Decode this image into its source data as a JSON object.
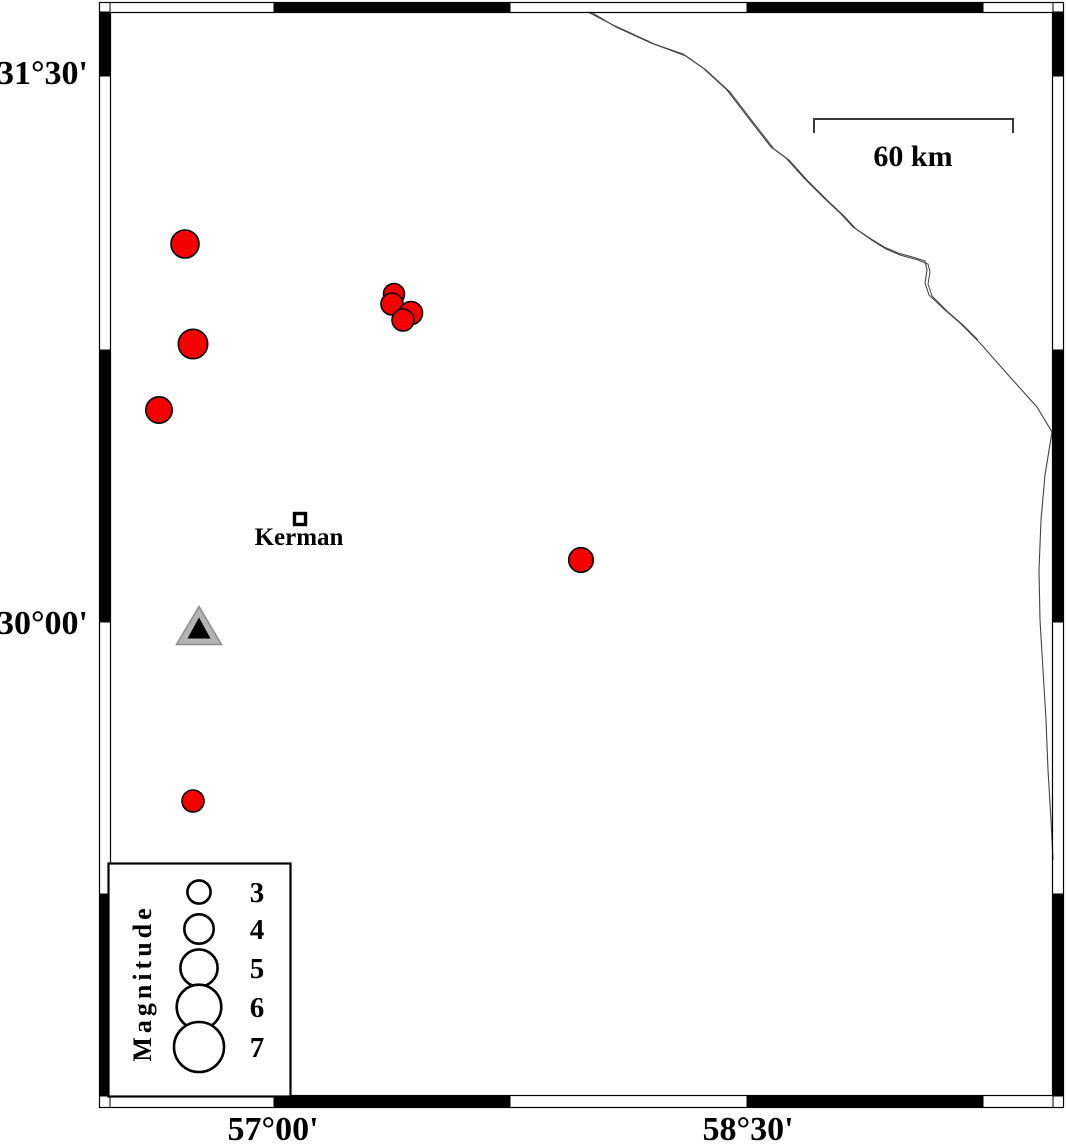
{
  "map": {
    "type": "seismicity-map",
    "background": "#ffffff"
  },
  "axis_labels": {
    "left": [
      {
        "text": "31°30'",
        "x": 88,
        "y": 84
      },
      {
        "text": "30°00'",
        "x": 88,
        "y": 634
      }
    ],
    "bottom": [
      {
        "text": "57°00'",
        "x": 273,
        "y": 1140
      },
      {
        "text": "58°30'",
        "x": 748,
        "y": 1140
      }
    ]
  },
  "frame": {
    "outer": {
      "x": 99,
      "y": 2,
      "w": 965,
      "h": 1106
    },
    "inner": {
      "x": 110,
      "y": 12,
      "w": 943,
      "h": 1084
    },
    "x_boundaries": [
      110,
      274,
      510,
      747,
      983,
      1053
    ],
    "x_black_segments": [
      [
        274,
        510
      ],
      [
        747,
        983
      ]
    ],
    "y_boundaries": [
      12,
      76,
      350,
      622,
      894,
      1096
    ],
    "y_black_segments": [
      [
        12,
        76
      ],
      [
        350,
        622
      ],
      [
        894,
        1096
      ]
    ],
    "band_color": "#000000"
  },
  "scale_bar": {
    "label": "60 km",
    "path": "M814,133 L814,119 L1013,119 L1013,133",
    "label_x": 913,
    "label_y": 166,
    "color": "#3a3a3a"
  },
  "coastline": {
    "color": "#444444",
    "main_d": "M588,12 L613,25 L648,41 L654,44 L683,54 L703,68 L727,90 L750,120 L771,147 L786,158 L804,178 L824,198 L841,214 L853,227 L871,239 L884,247 L898,253 L916,258 L925,261 L927,270 L925,283 L929,295 L945,310 L960,323 L980,343 L1010,377 L1037,407 L1052,432 L1045,475 L1041,520 L1039,570 L1040,620 L1043,670 L1046,720 L1048,770 L1051,820 L1053,860",
    "parallel_d": "M591,12 L616,27 L651,43 L686,56 L706,70 L730,92 L753,122 L774,149 L789,160 L807,180 L827,200 L844,216 L856,229 L873,241 L886,249 L900,255 L918,260 L928,264 L930,272 L928,284 L932,296 L948,312 L963,325 L978,340"
  },
  "city": {
    "name": "Kerman",
    "marker": "open-square",
    "x": 300,
    "y": 519,
    "label_x": 299,
    "label_y": 545
  },
  "station": {
    "marker": "triangle",
    "outer_points": "199,606.5 176.5,644.5 221.5,644.5",
    "inner_points": "199,617.5 187.5,638.5 210.5,638.5",
    "fill": "#b4b4b4",
    "edge": "#8c8c8c",
    "inner_fill": "#000000"
  },
  "earthquakes": {
    "marker": "circle",
    "fill": "#f40000",
    "outline": "#000000",
    "points": [
      {
        "x": 185,
        "y": 244,
        "r": 14.0
      },
      {
        "x": 193,
        "y": 344,
        "r": 14.7
      },
      {
        "x": 159,
        "y": 410,
        "r": 13.2
      },
      {
        "x": 394,
        "y": 294,
        "r": 10.5
      },
      {
        "x": 392,
        "y": 304,
        "r": 11.0
      },
      {
        "x": 411,
        "y": 313,
        "r": 11.5
      },
      {
        "x": 403,
        "y": 320,
        "r": 11.0
      },
      {
        "x": 581,
        "y": 560,
        "r": 12.3
      },
      {
        "x": 193,
        "y": 801,
        "r": 11.0
      }
    ]
  },
  "legend": {
    "title": "Magnitude",
    "box": {
      "x": 108.5,
      "y": 863.5,
      "w": 182,
      "h": 233
    },
    "circle_cx": 199,
    "label_x": 257,
    "entries": [
      {
        "magnitude": "3",
        "cy": 892,
        "r": 11.6
      },
      {
        "magnitude": "4",
        "cy": 929,
        "r": 14.7
      },
      {
        "magnitude": "5",
        "cy": 968,
        "r": 18.6
      },
      {
        "magnitude": "6",
        "cy": 1007,
        "r": 22.3
      },
      {
        "magnitude": "7",
        "cy": 1047,
        "r": 25.0
      }
    ]
  }
}
